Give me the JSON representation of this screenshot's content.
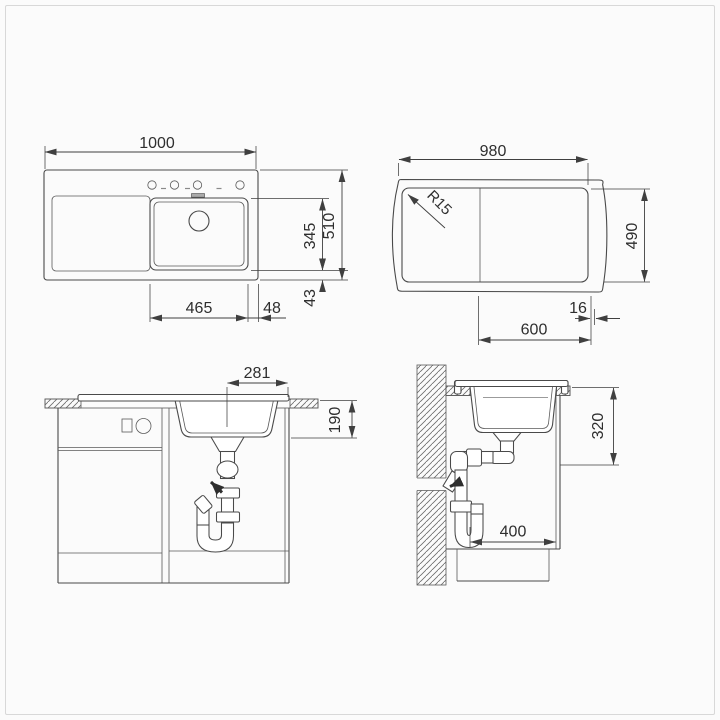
{
  "page": {
    "background": "#fbfbfb",
    "frame_color": "#d8d8d8",
    "line_color": "#4a4a4a",
    "dim_text_color": "#2e2e2e"
  },
  "views": {
    "plan_left": {
      "description": "sink plan view with bowl right",
      "dims": {
        "overall_width": "1000",
        "overall_depth": "510",
        "bowl_length": "345",
        "bowl_rear_gap": "43",
        "bowl_width": "465",
        "bowl_side_gap": "48"
      }
    },
    "plan_right": {
      "description": "worktop cutout plan view",
      "dims": {
        "cutout_width": "980",
        "cutout_depth": "490",
        "corner_radius": "R15",
        "bowl_zone_width": "600",
        "edge_gap": "16"
      }
    },
    "front_section": {
      "description": "front elevation with cabinet and siphon",
      "dims": {
        "drain_center_to_edge": "281",
        "bowl_depth": "190"
      }
    },
    "side_section": {
      "description": "side section at wall with siphon",
      "dims": {
        "outlet_height": "320",
        "clearance_width": "400"
      }
    }
  }
}
